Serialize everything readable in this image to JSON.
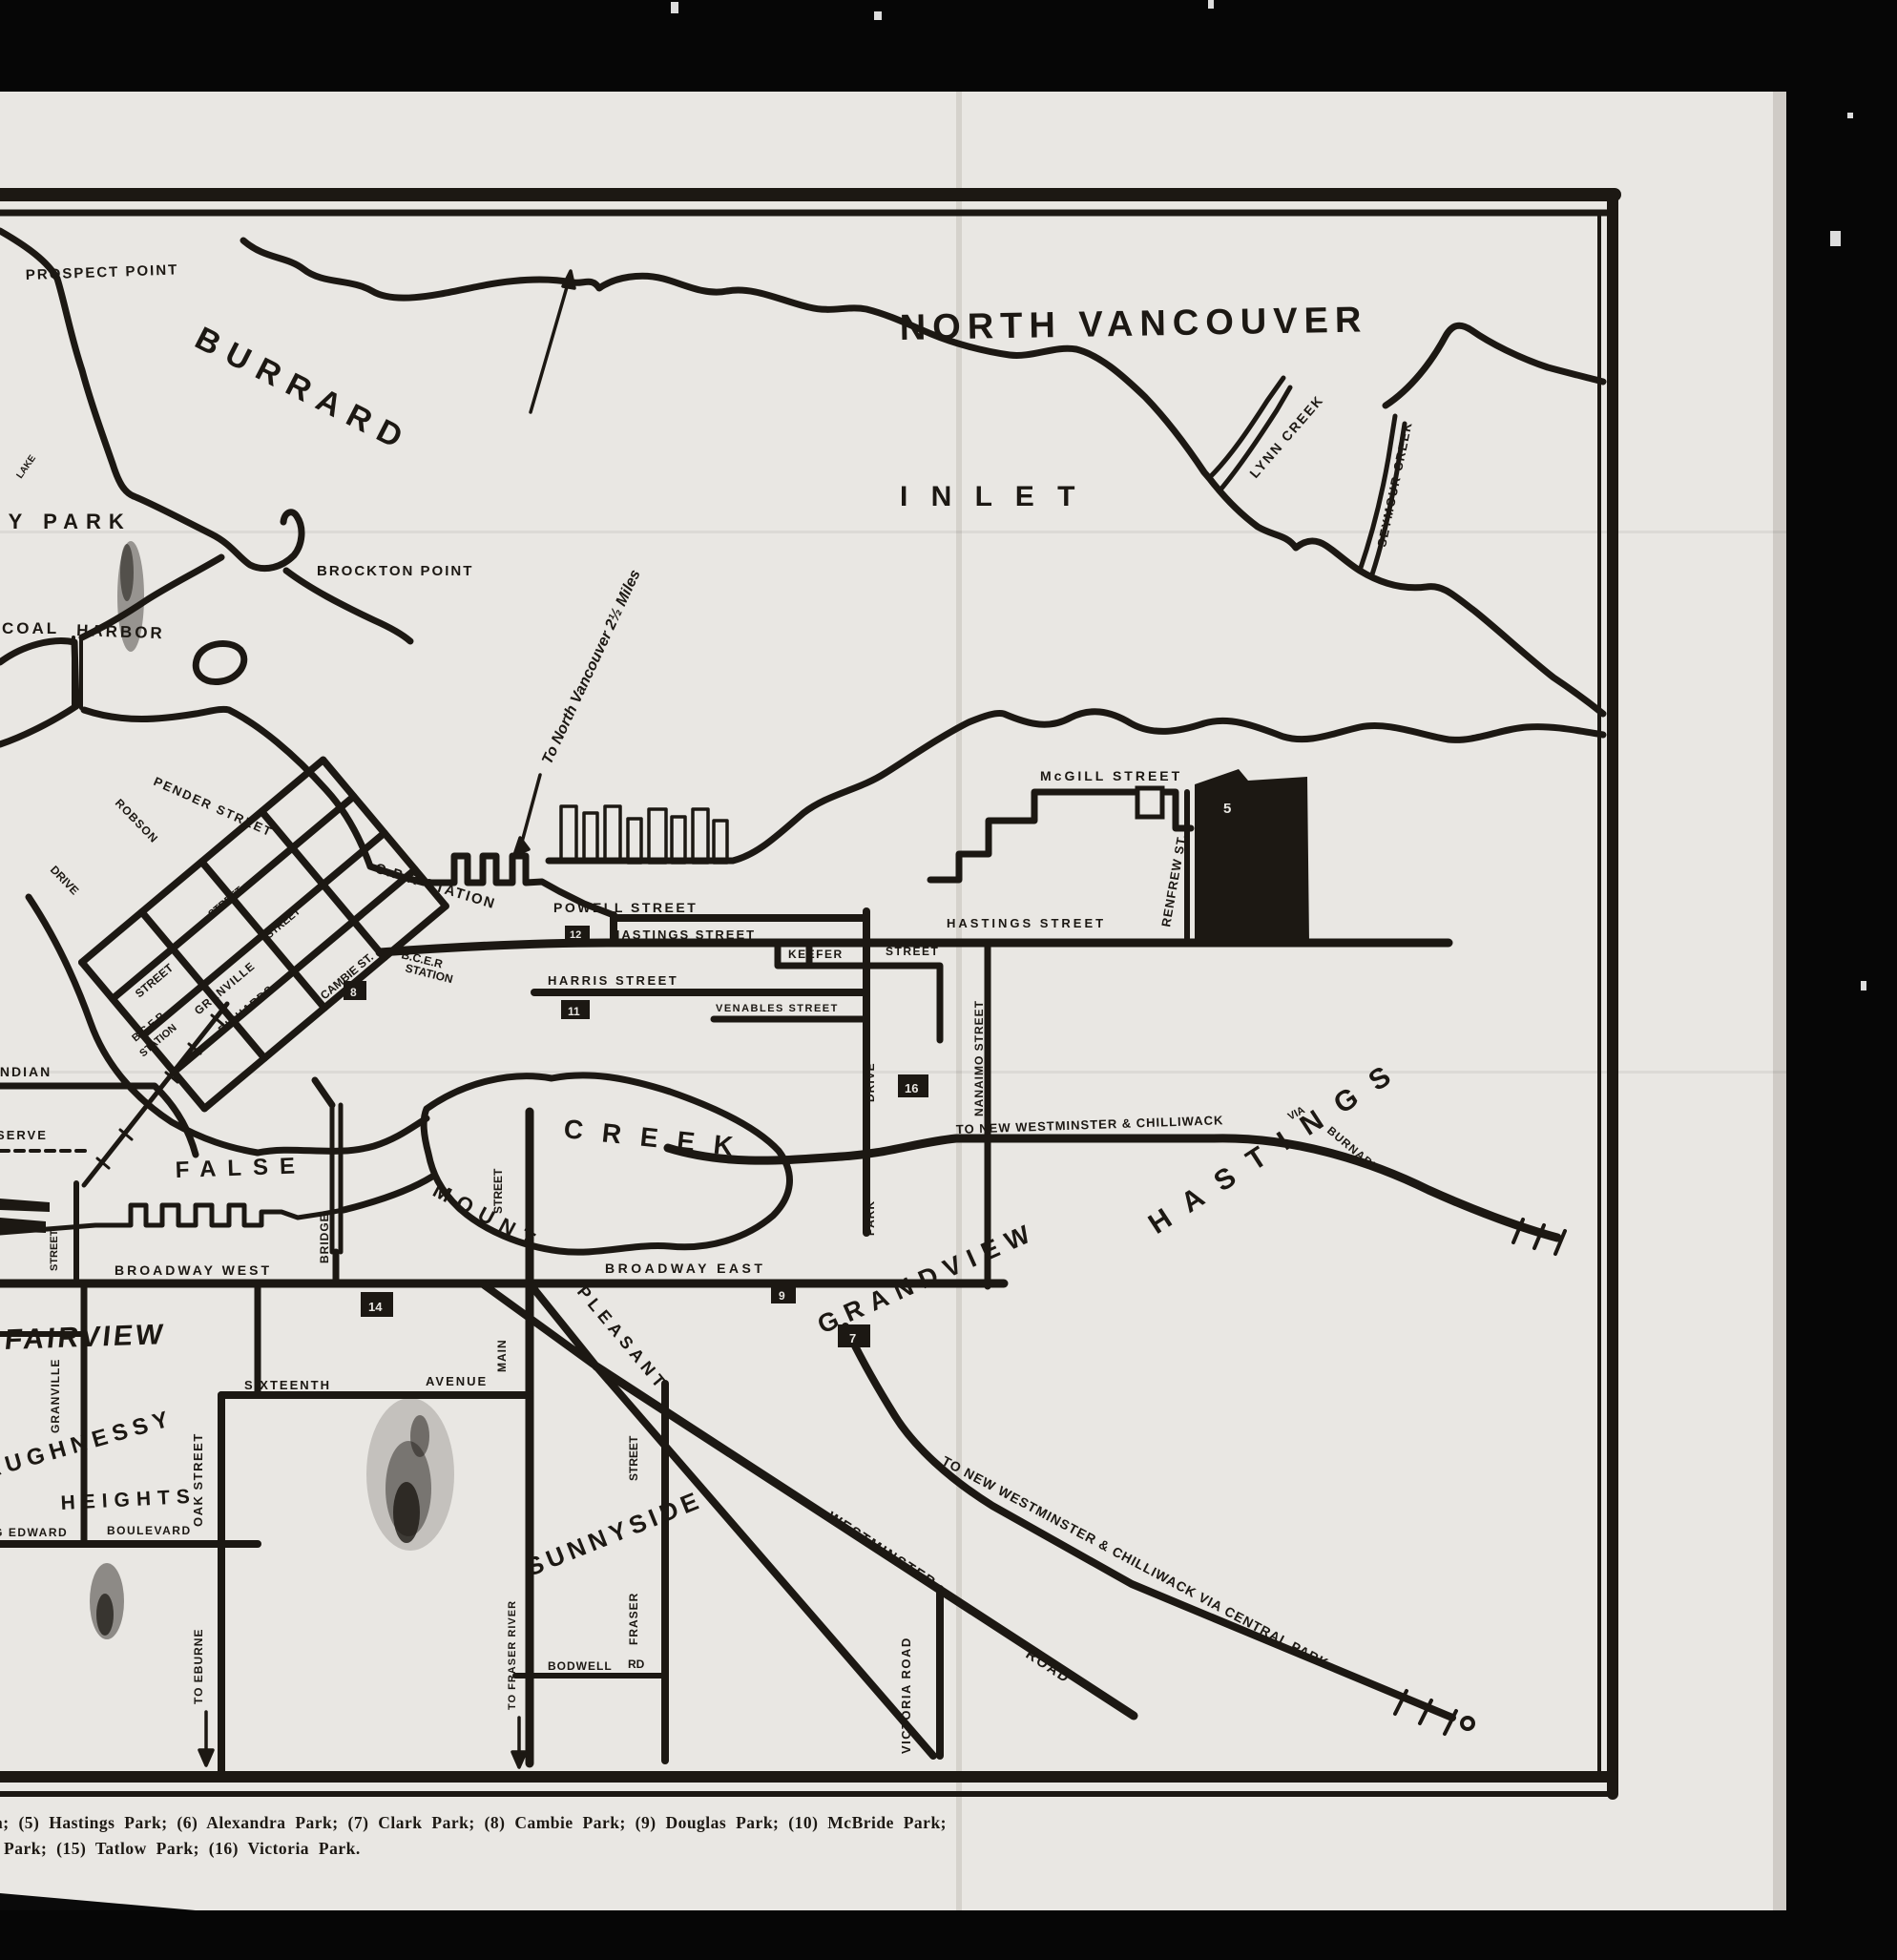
{
  "colors": {
    "background": "#060606",
    "paper": "#e9e7e3",
    "ink": "#1c1813"
  },
  "legend": {
    "line1": "a; (5) Hastings Park; (6) Alexandra Park; (7) Clark Park; (8) Cambie Park; (9)  Douglas  Park;  (10)  McBride  Park;",
    "line2": "Park; (15) Tatlow Park; (16) Victoria Park."
  },
  "labels": {
    "north_vancouver": "NORTH  VANCOUVER",
    "burrard": "BURRARD",
    "inlet": "I N L E T",
    "lynn_creek": "LYNN  CREEK",
    "seymour_creek": "SEYMOUR CREEK",
    "prospect_point": "PROSPECT POINT",
    "brockton_point": "BROCKTON  POINT",
    "stanley_park_fragment": "EY PARK",
    "lake": "LAKE",
    "coal": "COAL",
    "harbor": "HARBOR",
    "to_north_vancouver": "To North Vancouver 2½ Miles",
    "cpr_station": "C.P.R STATION",
    "bcer1": "B.C.E.R",
    "bcer2": "STATION",
    "powell_street": "POWELL  STREET",
    "hastings_street_w": "HASTINGS  STREET",
    "hastings_street_e": "HASTINGS   STREET",
    "harris_street": "HARRIS   STREET",
    "keefer": "KEEFER",
    "street_word_keefer": "STREET",
    "venables_street": "VENABLES  STREET",
    "nanaimo_street": "NANAIMO STREET",
    "park_word": "PARK",
    "drive_word": "DRIVE",
    "mcgill_street": "McGILL  STREET",
    "renfrew_st": "RENFREW ST.",
    "pender_street": "PENDER  STREET",
    "robson": "ROBSON",
    "drive_downtown": "DRIVE",
    "granville_downtown": "GRANVILLE",
    "street_word_a": "STREET",
    "street_word_b": "STREET",
    "street_word_c": "STREET",
    "richards": "RICHARDS",
    "cambie_st": "CAMBIE ST.",
    "false_word": "FALSE",
    "creek_word": "CREEK",
    "indian": "INDIAN",
    "reserve": "RESERVE",
    "bridge_vert": "BRIDGE",
    "street_granville_s": "STREET",
    "broadway_west": "BROADWAY  WEST",
    "broadway_east": "BROADWAY   EAST",
    "grandview": "GRANDVIEW",
    "mount": "MOUNT",
    "pleasant": "PLEASANT",
    "main_vert": "MAIN",
    "street_main_vert": "STREET",
    "sixteenth": "SIXTEENTH",
    "avenue": "AVENUE",
    "fairview": "FAIRVIEW",
    "granville_vert": "GRANVILLE",
    "shaughnessy": "SHAUGHNESSY",
    "heights": "HEIGHTS",
    "king_edward": "KING EDWARD",
    "boulevard": "BOULEVARD",
    "oak_street_vert": "OAK  STREET",
    "to_eburne": "TO EBURNE",
    "sunnyside": "SUNNYSIDE",
    "fraser_vert": "FRASER",
    "street_fraser_vert": "STREET",
    "bodwell": "BODWELL",
    "rd": "RD",
    "to_fraser_river": "TO FRASER RIVER",
    "westminster_diag": "WESTMINSTER",
    "road_diag": "ROAD",
    "victoria_road": "VICTORIA ROAD",
    "to_new_westminster_burnaby": "TO NEW WESTMINSTER & CHILLIWACK",
    "via": "VIA",
    "burnaby": "BURNABY",
    "to_new_westminster_central": "TO NEW WESTMINSTER & CHILLIWACK VIA CENTRAL PARK",
    "hastings_townsite": "H A S T I N G S"
  },
  "markers": {
    "m5": "5",
    "m7": "7",
    "m8": "8",
    "m9": "9",
    "m11": "11",
    "m12": "12",
    "m14": "14",
    "m16": "16"
  }
}
